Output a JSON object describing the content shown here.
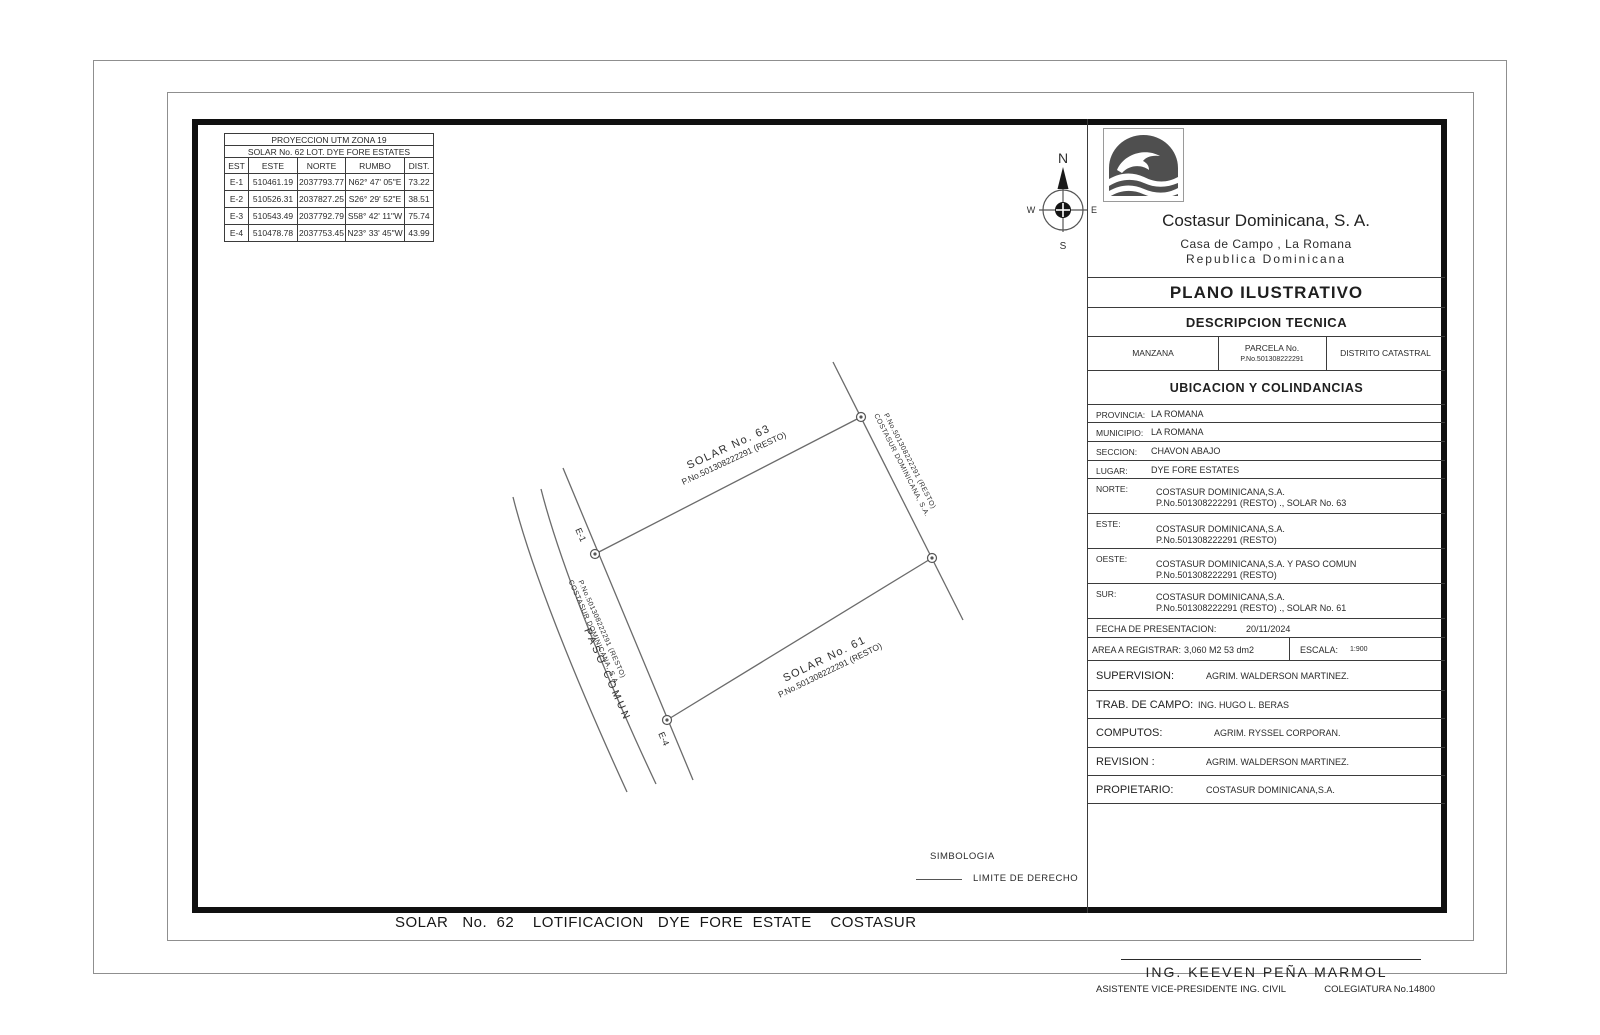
{
  "doc": {
    "sheet_title": "SOLAR   No.  62    LOTIFICACION   DYE  FORE  ESTATE    COSTASUR"
  },
  "colors": {
    "frame": "#101010",
    "line_gray": "#6b6b6b",
    "muted_gray": "#c2c2c2",
    "logo_gray": "#4f4f4f"
  },
  "coord_table": {
    "title1": "PROYECCION UTM ZONA 19",
    "title2": "SOLAR No. 62 LOT. DYE FORE ESTATES",
    "headers": [
      "EST",
      "ESTE",
      "NORTE",
      "RUMBO",
      "DIST."
    ],
    "rows": [
      [
        "E-1",
        "510461.19",
        "2037793.77",
        "N62° 47' 05\"E",
        "73.22"
      ],
      [
        "E-2",
        "510526.31",
        "2037827.25",
        "S26° 29' 52\"E",
        "38.51"
      ],
      [
        "E-3",
        "510543.49",
        "2037792.79",
        "S58° 42' 11\"W",
        "75.74"
      ],
      [
        "E-4",
        "510478.78",
        "2037753.45",
        "N23° 33' 45\"W",
        "43.99"
      ]
    ]
  },
  "compass": {
    "n": "N",
    "e": "E",
    "s": "S",
    "w": "W"
  },
  "drawing": {
    "solar63_name": "SOLAR No. 63",
    "solar63_parcel": "P.No.501308222291 (RESTO)",
    "solar61_name": "SOLAR No. 61",
    "solar61_parcel": "P.No.501308222291 (RESTO)",
    "east_line1": "P.No.501308222291 (RESTO)",
    "east_line2": "COSTASUR DOMINICANA, S.A.",
    "west_line1": "P.No.501308222291 (RESTO)",
    "west_line2": "COSTASUR DOMINICANA, S.A.",
    "paso_comun": "PASO COMUN",
    "station_e1": "E-1",
    "station_e4": "E-4"
  },
  "simbologia": {
    "title": "SIMBOLOGIA",
    "limite_de_derecho": "LIMITE DE DERECHO"
  },
  "title_block": {
    "company_name": "Costasur Dominicana, S. A.",
    "address_line1": "Casa de Campo , La Romana",
    "address_line2": "Republica Dominicana",
    "plano_title": "PLANO ILUSTRATIVO",
    "descripcion_title": "DESCRIPCION TECNICA",
    "manzana_label": "MANZANA",
    "parcela_label": "PARCELA No.",
    "parcela_value": "P.No.501308222291",
    "distrito_label": "DISTRITO CATASTRAL",
    "ubicacion_title": "UBICACION Y COLINDANCIAS",
    "ubic_rows": [
      {
        "label": "PROVINCIA:",
        "line1": "LA ROMANA"
      },
      {
        "label": "MUNICIPIO:",
        "line1": "LA ROMANA"
      },
      {
        "label": "SECCION:",
        "line1": "CHAVON ABAJO"
      },
      {
        "label": "LUGAR:",
        "line1": "DYE FORE ESTATES"
      },
      {
        "label": "NORTE:",
        "line1": "COSTASUR DOMINICANA,S.A.",
        "line2": "P.No.501308222291 (RESTO) ., SOLAR No. 63"
      },
      {
        "label": "ESTE:",
        "line1": "COSTASUR DOMINICANA,S.A.",
        "line2": "P.No.501308222291 (RESTO)"
      },
      {
        "label": "OESTE:",
        "line1": "COSTASUR DOMINICANA,S.A. Y PASO COMUN",
        "line2": "P.No.501308222291 (RESTO)"
      },
      {
        "label": "SUR:",
        "line1": "COSTASUR DOMINICANA,S.A.",
        "line2": "P.No.501308222291 (RESTO) ., SOLAR No. 61"
      }
    ],
    "fecha_label": "FECHA DE PRESENTACION:",
    "fecha_value": "20/11/2024",
    "area_label": "AREA A REGISTRAR:",
    "area_value": "3,060 M2 53 dm2",
    "escala_label": "ESCALA:",
    "escala_value": "1:900",
    "staff_rows": [
      {
        "label": "SUPERVISION:",
        "value": "AGRIM. WALDERSON MARTINEZ."
      },
      {
        "label": "TRAB. DE CAMPO:",
        "value": "ING. HUGO L. BERAS"
      },
      {
        "label": "COMPUTOS:",
        "value": "AGRIM. RYSSEL CORPORAN."
      },
      {
        "label": "REVISION :",
        "value": "AGRIM. WALDERSON MARTINEZ."
      },
      {
        "label": "PROPIETARIO:",
        "value": "COSTASUR DOMINICANA,S.A."
      }
    ],
    "firma_name": "ING. KEEVEN PEÑA MARMOL",
    "firma_title": "ASISTENTE VICE-PRESIDENTE ING. CIVIL",
    "firma_colegiatura": "COLEGIATURA No.14800"
  }
}
